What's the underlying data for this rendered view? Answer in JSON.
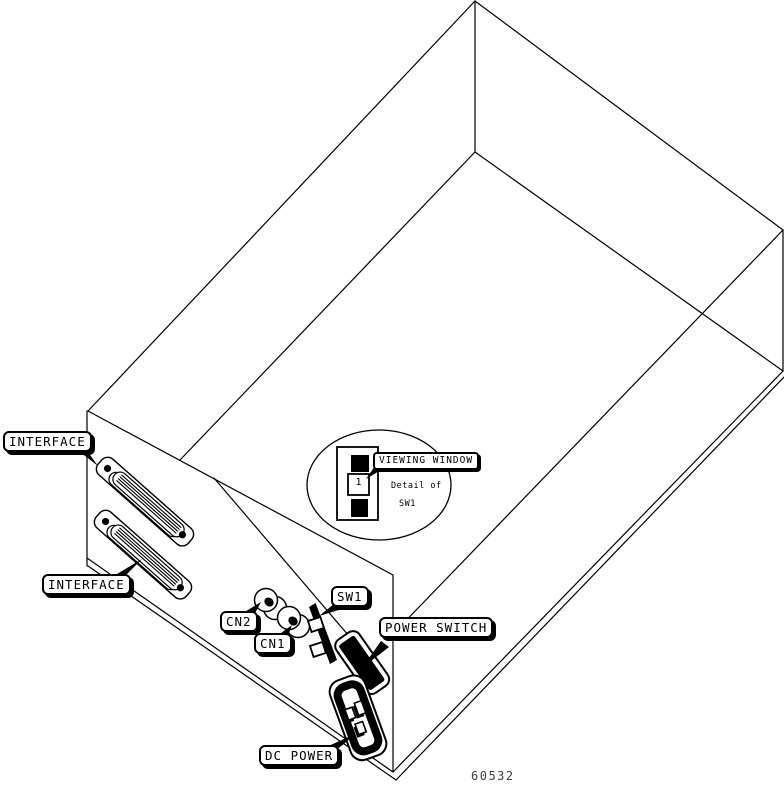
{
  "figure": {
    "number": "60532"
  },
  "callouts": {
    "interface_top": "INTERFACE",
    "interface_bottom": "INTERFACE",
    "cn2": "CN2",
    "cn1": "CN1",
    "sw1": "SW1",
    "power_switch": "POWER SWITCH",
    "dc_power": "DC POWER",
    "viewing_window": "VIEWING WINDOW"
  },
  "detail_bubble": {
    "caption_line1": "Detail of",
    "caption_line2": "SW1",
    "window_value": "1"
  },
  "colors": {
    "line": "#000000",
    "background": "#ffffff",
    "label_background": "#ffffff",
    "figure_number_text": "#3d3d3d"
  }
}
